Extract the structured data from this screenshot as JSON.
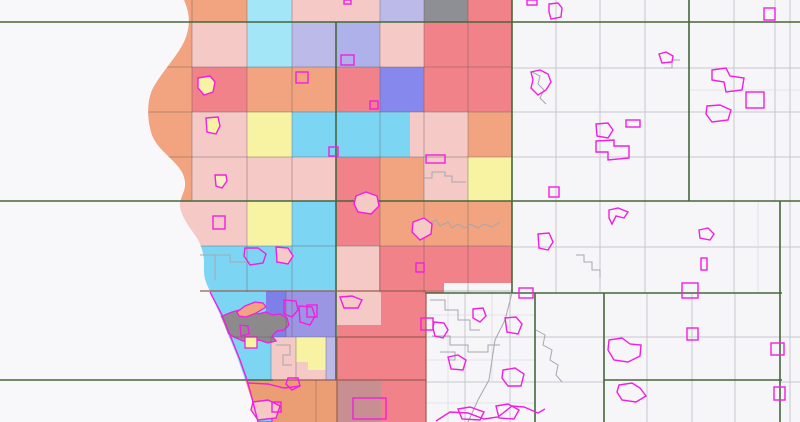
{
  "map": {
    "width": 800,
    "height": 422,
    "background": "#F6F6F9",
    "lake_fill": "#F8F8FB",
    "magenta": "#F21EE0",
    "green": "#45673B",
    "dark": "#9C5B50",
    "grid_white": "#C5C6D0",
    "grid_fine": "#DBDBE3",
    "grid_colored": "rgba(100,85,85,0.4)",
    "municipal": [
      "424,178 432,178 432,172 445,172 445,176 452,176 452,182 466,182",
      "428,224 436,220 440,226 448,222 452,228 458,224 465,228 470,224 478,228 484,224 492,227 500,222",
      "532,72 540,76 538,84 544,90 540,98 546,104",
      "576,255 584,255 584,262 592,262 592,270 600,270 600,278",
      "430,300 445,300 445,310 458,310 458,320 470,320 470,330 480,330",
      "432,336 450,336 450,345 468,345 468,352 488,352 488,345 500,345",
      "512,293 505,320 495,340 492,360 489,380 478,400 468,422",
      "536,330 545,335 543,345 552,350 550,360 558,365 556,375 562,382",
      "680,60 672,60 672,68 664,68",
      "200,255 230,255 230,262 250,262",
      "215,255 215,280",
      "276,345 290,345 290,355 283,355 283,365 292,365",
      "440,352 455,352 455,360 448,360"
    ],
    "palette": {
      "salmon": "#F1A47F",
      "salmonD": "#EB9E74",
      "pink": "#F5CAC6",
      "red": "#F18289",
      "cyanL": "#A3E6F8",
      "cyan": "#7CD6F3",
      "lav": "#BCBAE8",
      "lav2": "#AFB2EA",
      "blue": "#8788ED",
      "blue2": "#7E7FE9",
      "purple": "#9B96E4",
      "yellow": "#F8F3A3",
      "grayc": "#8E8E95",
      "mauve": "#C88F92",
      "urban": "#8C8A8B",
      "white": "#F6F6F9"
    },
    "lake_path": "M184,0 C190,14 191,26 184,42 C176,58 160,74 152,90 C147,102 147,118 151,132 C154,143 162,150 170,158 C178,166 184,172 185,182 C186,192 179,198 180,207 C182,218 190,228 197,238 C202,247 204,255 204,263 C204,271 203,276 208,287 C213,299 219,312 224,324 C230,340 236,352 241,368 C246,382 250,395 254,408 L258,422 L0,422 L0,0 Z",
    "cells": [
      [
        150,
        0,
        42,
        22,
        "salmon"
      ],
      [
        192,
        0,
        55,
        22,
        "salmon"
      ],
      [
        247,
        0,
        45,
        22,
        "cyanL"
      ],
      [
        292,
        0,
        44,
        22,
        "pink"
      ],
      [
        336,
        0,
        44,
        22,
        "pink"
      ],
      [
        380,
        0,
        44,
        22,
        "lav"
      ],
      [
        424,
        0,
        44,
        22,
        "grayc"
      ],
      [
        468,
        0,
        44,
        22,
        "red"
      ],
      [
        150,
        22,
        42,
        45,
        "salmon"
      ],
      [
        192,
        22,
        55,
        45,
        "pink"
      ],
      [
        247,
        22,
        45,
        45,
        "cyanL"
      ],
      [
        292,
        22,
        44,
        45,
        "lav"
      ],
      [
        336,
        22,
        44,
        45,
        "lav2"
      ],
      [
        380,
        22,
        44,
        45,
        "pink"
      ],
      [
        424,
        22,
        44,
        45,
        "red"
      ],
      [
        468,
        22,
        44,
        45,
        "red"
      ],
      [
        140,
        67,
        52,
        45,
        "salmon"
      ],
      [
        192,
        67,
        55,
        45,
        "red"
      ],
      [
        247,
        67,
        45,
        45,
        "salmon"
      ],
      [
        292,
        67,
        44,
        45,
        "salmon"
      ],
      [
        336,
        67,
        44,
        45,
        "red"
      ],
      [
        380,
        67,
        44,
        45,
        "blue"
      ],
      [
        424,
        67,
        44,
        45,
        "red"
      ],
      [
        468,
        67,
        44,
        45,
        "red"
      ],
      [
        140,
        112,
        52,
        45,
        "salmon"
      ],
      [
        192,
        112,
        55,
        45,
        "pink"
      ],
      [
        247,
        112,
        45,
        45,
        "yellow"
      ],
      [
        292,
        112,
        44,
        45,
        "cyan"
      ],
      [
        336,
        112,
        44,
        45,
        "cyan"
      ],
      [
        380,
        112,
        30,
        45,
        "cyan"
      ],
      [
        410,
        112,
        58,
        45,
        "pink"
      ],
      [
        468,
        112,
        44,
        45,
        "salmon"
      ],
      [
        150,
        157,
        42,
        44,
        "salmon"
      ],
      [
        192,
        157,
        55,
        44,
        "pink"
      ],
      [
        247,
        157,
        45,
        44,
        "pink"
      ],
      [
        292,
        157,
        44,
        44,
        "pink"
      ],
      [
        336,
        157,
        44,
        44,
        "red"
      ],
      [
        380,
        157,
        44,
        44,
        "salmon"
      ],
      [
        424,
        157,
        44,
        44,
        "pink"
      ],
      [
        468,
        157,
        44,
        44,
        "yellow"
      ],
      [
        170,
        201,
        22,
        45,
        "pink"
      ],
      [
        192,
        201,
        55,
        45,
        "pink"
      ],
      [
        247,
        201,
        45,
        45,
        "yellow"
      ],
      [
        292,
        201,
        44,
        45,
        "cyan"
      ],
      [
        336,
        201,
        44,
        45,
        "red"
      ],
      [
        380,
        201,
        44,
        45,
        "salmon"
      ],
      [
        424,
        201,
        44,
        45,
        "salmon"
      ],
      [
        468,
        201,
        44,
        45,
        "salmon"
      ],
      [
        190,
        246,
        146,
        45,
        "cyan"
      ],
      [
        336,
        246,
        43,
        45,
        "pink"
      ],
      [
        379,
        246,
        47,
        45,
        "red"
      ],
      [
        426,
        246,
        86,
        47,
        "red"
      ],
      [
        200,
        291,
        66,
        46,
        "cyan"
      ],
      [
        266,
        291,
        20,
        46,
        "blue2"
      ],
      [
        286,
        291,
        50,
        46,
        "purple"
      ],
      [
        336,
        291,
        45,
        34,
        "pink"
      ],
      [
        337,
        325,
        89,
        12,
        "red"
      ],
      [
        381,
        291,
        45,
        46,
        "red"
      ],
      [
        215,
        337,
        56,
        43,
        "cyan"
      ],
      [
        271,
        337,
        25,
        43,
        "pink"
      ],
      [
        296,
        337,
        42,
        43,
        "pink"
      ],
      [
        326,
        337,
        12,
        43,
        "lav"
      ],
      [
        338,
        337,
        88,
        43,
        "red"
      ],
      [
        296,
        337,
        30,
        25,
        "yellow"
      ],
      [
        308,
        362,
        18,
        8,
        "yellow"
      ],
      [
        244,
        380,
        93,
        42,
        "salmonD"
      ],
      [
        337,
        380,
        44,
        42,
        "mauve"
      ],
      [
        381,
        380,
        45,
        42,
        "red"
      ]
    ],
    "patches": [
      {
        "t": "r",
        "x": 444,
        "y": 283,
        "w": 68,
        "h": 10,
        "f": "white"
      },
      {
        "t": "p",
        "pts": "220,317 232,312 243,309 254,310 258,314 266,312 272,315 280,314 287,318 289,325 284,330 277,331 272,336 276,341 268,343 259,340 251,343 243,341 234,337 226,332 221,325",
        "f": "urban",
        "s": true
      },
      {
        "t": "p",
        "pts": "240,325 248,326 249,334 241,336",
        "f": "urban",
        "s": true
      },
      {
        "t": "p",
        "pts": "237,312 245,306 255,302 263,303 266,307 256,313 246,317 239,316",
        "f": "salmon",
        "s": true
      },
      {
        "t": "r",
        "x": 245,
        "y": 337,
        "w": 12,
        "h": 11,
        "f": "yellow",
        "s": true
      },
      {
        "t": "r",
        "x": 255,
        "y": 406,
        "w": 12,
        "h": 12,
        "f": "white",
        "s": true
      },
      {
        "t": "p",
        "pts": "258,404 272,403 272,422 252,422",
        "f": "cyan",
        "s": true
      }
    ],
    "grid_colored_v": [
      [
        192,
        0,
        201
      ],
      [
        247,
        0,
        292
      ],
      [
        292,
        0,
        337
      ],
      [
        380,
        0,
        293
      ],
      [
        424,
        0,
        293
      ],
      [
        468,
        0,
        293
      ],
      [
        271,
        337,
        380
      ],
      [
        296,
        337,
        380
      ],
      [
        326,
        337,
        380
      ],
      [
        286,
        291,
        337
      ],
      [
        316,
        380,
        422
      ]
    ],
    "grid_colored_h": [
      [
        67,
        148,
        512
      ],
      [
        112,
        146,
        512
      ],
      [
        157,
        150,
        512
      ],
      [
        246,
        190,
        512
      ],
      [
        291,
        200,
        512
      ],
      [
        337,
        205,
        337
      ]
    ],
    "grid_white_v": [
      [
        556,
        0,
        293
      ],
      [
        600,
        0,
        293
      ],
      [
        645,
        0,
        293
      ],
      [
        734,
        0,
        293
      ],
      [
        775,
        0,
        201
      ],
      [
        465,
        293,
        422
      ],
      [
        510,
        293,
        422
      ],
      [
        647,
        293,
        422
      ],
      [
        692,
        293,
        422
      ],
      [
        735,
        293,
        422
      ],
      [
        790,
        0,
        422
      ]
    ],
    "grid_white_h": [
      [
        68,
        512,
        800
      ],
      [
        112,
        512,
        800
      ],
      [
        157,
        512,
        800
      ],
      [
        247,
        512,
        800
      ],
      [
        337,
        426,
        800
      ],
      [
        382,
        426,
        604
      ],
      [
        382,
        780,
        800
      ]
    ],
    "grid_fine_v": [
      [
        448,
        293,
        422
      ],
      [
        492,
        293,
        381
      ],
      [
        758,
        201,
        293
      ]
    ],
    "grid_fine_h": [
      [
        315,
        426,
        535
      ],
      [
        360,
        426,
        535
      ],
      [
        403,
        426,
        535
      ],
      [
        90,
        689,
        800
      ]
    ],
    "green_h": [
      [
        22,
        0,
        800
      ],
      [
        201,
        0,
        800
      ],
      [
        293,
        425,
        782
      ],
      [
        380,
        0,
        273
      ],
      [
        380,
        604,
        782
      ]
    ],
    "green_v": [
      [
        336,
        22,
        380
      ],
      [
        512,
        0,
        293
      ],
      [
        689,
        0,
        201
      ],
      [
        780,
        201,
        422
      ],
      [
        604,
        293,
        422
      ],
      [
        535,
        293,
        422
      ]
    ],
    "dark_lines": [
      [
        426,
        293,
        426,
        422
      ],
      [
        273,
        380,
        426,
        380
      ],
      [
        337,
        337,
        426,
        337
      ],
      [
        337,
        337,
        337,
        422
      ],
      [
        200,
        291,
        426,
        291
      ]
    ],
    "city_shapes": [
      {
        "t": "r",
        "x": 344,
        "y": 0,
        "w": 7,
        "h": 4
      },
      {
        "t": "r",
        "x": 527,
        "y": 0,
        "w": 10,
        "h": 5
      },
      {
        "t": "p",
        "pts": "549,4 558,3 562,8 561,17 551,19 549,12"
      },
      {
        "t": "r",
        "x": 764,
        "y": 8,
        "w": 11,
        "h": 12
      },
      {
        "t": "p",
        "pts": "531,72 540,70 548,74 551,82 546,90 538,95 531,88 533,80"
      },
      {
        "t": "p",
        "pts": "659,54 666,52 673,56 672,62 662,63"
      },
      {
        "t": "p",
        "pts": "712,70 726,68 730,76 744,78 742,90 726,92 724,82 712,80"
      },
      {
        "t": "r",
        "x": 746,
        "y": 92,
        "w": 18,
        "h": 16
      },
      {
        "t": "p",
        "pts": "707,106 720,105 731,110 728,120 712,122 706,114"
      },
      {
        "t": "r",
        "x": 626,
        "y": 120,
        "w": 14,
        "h": 7
      },
      {
        "t": "p",
        "pts": "596,124 608,123 613,130 608,138 597,136"
      },
      {
        "t": "p",
        "pts": "596,141 614,140 614,146 629,146 629,158 608,160 608,152 596,152"
      },
      {
        "t": "r",
        "x": 549,
        "y": 187,
        "w": 10,
        "h": 10
      },
      {
        "t": "p",
        "pts": "609,210 618,208 628,212 624,218 616,216 612,224 609,218"
      },
      {
        "t": "p",
        "pts": "538,234 549,233 553,242 548,250 539,248"
      },
      {
        "t": "p",
        "pts": "699,230 708,228 714,234 710,240 700,238"
      },
      {
        "t": "r",
        "x": 701,
        "y": 258,
        "w": 6,
        "h": 12
      },
      {
        "t": "r",
        "x": 519,
        "y": 288,
        "w": 14,
        "h": 10
      },
      {
        "t": "r",
        "x": 682,
        "y": 283,
        "w": 16,
        "h": 15
      },
      {
        "t": "r",
        "x": 687,
        "y": 328,
        "w": 11,
        "h": 12
      },
      {
        "t": "p",
        "pts": "609,340 622,338 630,344 641,345 640,356 628,362 614,360 608,350"
      },
      {
        "t": "p",
        "pts": "619,385 632,383 640,388 646,396 636,402 622,400 617,392"
      },
      {
        "t": "r",
        "x": 771,
        "y": 343,
        "w": 13,
        "h": 12
      },
      {
        "t": "r",
        "x": 774,
        "y": 387,
        "w": 11,
        "h": 13
      },
      {
        "t": "r",
        "x": 421,
        "y": 318,
        "w": 12,
        "h": 12
      },
      {
        "t": "p",
        "pts": "434,322 444,323 448,330 443,338 435,336 433,328"
      },
      {
        "t": "p",
        "pts": "448,357 458,355 466,360 463,370 451,369"
      },
      {
        "t": "p",
        "pts": "503,370 515,368 524,374 521,386 508,386 502,378"
      },
      {
        "t": "p",
        "pts": "505,318 516,317 522,324 518,334 507,332"
      },
      {
        "t": "p",
        "pts": "496,406 508,404 519,410 514,419 499,418"
      },
      {
        "t": "p",
        "pts": "458,409 470,407 484,412 480,420 462,419"
      },
      {
        "t": "p",
        "pts": "473,309 483,308 486,316 480,322 473,318"
      },
      {
        "t": "r",
        "x": 341,
        "y": 55,
        "w": 13,
        "h": 10
      },
      {
        "t": "r",
        "x": 296,
        "y": 72,
        "w": 12,
        "h": 11
      },
      {
        "t": "r",
        "x": 370,
        "y": 101,
        "w": 8,
        "h": 8
      },
      {
        "t": "r",
        "x": 329,
        "y": 147,
        "w": 9,
        "h": 9
      },
      {
        "t": "r",
        "x": 426,
        "y": 155,
        "w": 19,
        "h": 8
      },
      {
        "t": "p",
        "pts": "215,175 226,175 227,181 222,188 216,186",
        "f": "#F6EFC0"
      },
      {
        "t": "r",
        "x": 213,
        "y": 216,
        "w": 12,
        "h": 13
      },
      {
        "t": "r",
        "x": 416,
        "y": 263,
        "w": 8,
        "h": 9
      },
      {
        "t": "r",
        "x": 307,
        "y": 305,
        "w": 10,
        "h": 12
      },
      {
        "t": "p",
        "pts": "284,300 296,301 298,310 292,317 284,314"
      },
      {
        "t": "p",
        "pts": "299,306 312,307 315,316 310,325 300,322"
      },
      {
        "t": "p",
        "pts": "340,297 352,296 362,300 358,308 344,308"
      },
      {
        "t": "p",
        "pts": "198,78 210,76 215,82 213,92 204,95 198,88",
        "f": "#F8F3A3"
      },
      {
        "t": "p",
        "pts": "206,118 218,117 220,126 216,134 207,132",
        "f": "#F8F3A3"
      },
      {
        "t": "p",
        "pts": "356,196 366,192 377,196 379,206 371,214 358,212 354,204",
        "f": "#F5CAC6"
      },
      {
        "t": "p",
        "pts": "413,222 424,218 432,224 431,234 420,240 412,232",
        "f": "#F5CAC6"
      },
      {
        "t": "p",
        "pts": "245,248 258,248 266,254 263,263 250,265 244,256"
      },
      {
        "t": "p",
        "pts": "276,247 288,248 293,256 288,264 277,262",
        "f": "#F5CAC6"
      },
      {
        "t": "p",
        "pts": "253,402 268,400 280,406 276,418 258,420 251,410",
        "f": "#F5CAC6"
      },
      {
        "t": "p",
        "pts": "288,378 298,378 300,386 292,390 286,384"
      },
      {
        "t": "r",
        "x": 272,
        "y": 402,
        "w": 9,
        "h": 10
      },
      {
        "t": "r",
        "x": 353,
        "y": 398,
        "w": 33,
        "h": 21
      },
      {
        "t": "l",
        "pts": "210,292 222,315 232,340 240,360 247,380 252,398 258,422"
      },
      {
        "t": "l",
        "pts": "436,421 450,412 468,413 484,419 498,417 512,406 524,407 538,413 545,409"
      },
      {
        "t": "l",
        "pts": "248,383 268,384 284,388 300,386"
      }
    ]
  }
}
